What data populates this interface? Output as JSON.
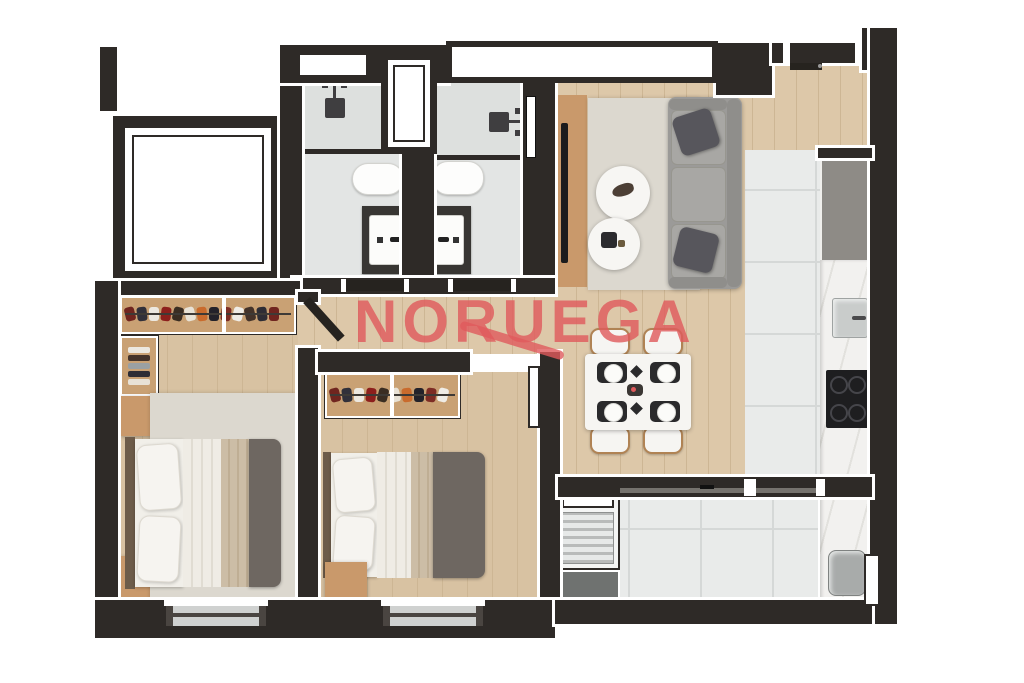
{
  "watermark": {
    "text": "NORUEGA",
    "color": "#e05a5c"
  },
  "palette": {
    "wall": "#2e2a27",
    "wood": "#ddc8a9",
    "wood2": "#d8c2a2",
    "woodline": "#cdb694",
    "tile": "#e9ebea",
    "tilegrid": "#d5d8d7",
    "bathtile": "#e3e5e4",
    "bathgrid": "#cfd2d1",
    "shower": "#dbdddc",
    "rug": "#dcd8cf",
    "tan": "#c9996b",
    "tan2": "#c9a174",
    "sofa": "#9b9a98",
    "sofadk": "#8f8e8b",
    "cushion": "#a8a7a4",
    "pillow": "#57565c",
    "duvet": "#6e6761",
    "blanket": "#ccbda6",
    "sheet": "#efece5",
    "headboard": "#6d5c4a",
    "offwhite": "#f6f5f2",
    "marble": "#f2f1ef",
    "vein": "#e2e1dd",
    "cabinet": "#8e8b86",
    "cooktop": "#1e1e20",
    "burner": "#45454a",
    "metal": "#c9cccb",
    "graybox": "#6f7270",
    "louver": "#b9bbba",
    "darkdoor": "#26231f",
    "matblack": "#2a2a2c",
    "woodtrim": "#b08354",
    "red": "#e05a5c"
  },
  "wardrobe": {
    "item_colors": [
      "#70251f",
      "#31303a",
      "#ece8e0",
      "#8d1f1c",
      "#3a2d22",
      "#e8e2d6",
      "#c96b2d",
      "#23222a",
      "#7d2c24",
      "#efece6",
      "#44332a",
      "#2e2d35"
    ]
  },
  "plan": {
    "type": "residential-apartment-floor-plan",
    "style": "top-down-3d-render",
    "rooms": [
      "elevator-shaft",
      "bathroom-1",
      "bathroom-2",
      "entry-foyer",
      "living-room",
      "dining-area",
      "kitchen",
      "hallway",
      "bedroom-1",
      "bedroom-2",
      "service-balcony"
    ],
    "furniture": [
      "gray-sofa-with-pillows",
      "tv-panel",
      "two-round-coffee-tables",
      "dining-table-4-chairs-4-place-settings",
      "kitchen-counter-with-sink-and-cooktop",
      "refrigerator-cabinet",
      "double-bed-1",
      "double-bed-2",
      "open-wardrobe-1",
      "open-wardrobe-2",
      "folded-clothes-shelf",
      "nightstands",
      "shower-1",
      "shower-2",
      "toilet-1",
      "toilet-2",
      "vanity-sink-1",
      "vanity-sink-2",
      "louver-vent-unit",
      "laundry-tub",
      "balcony-counter"
    ]
  }
}
